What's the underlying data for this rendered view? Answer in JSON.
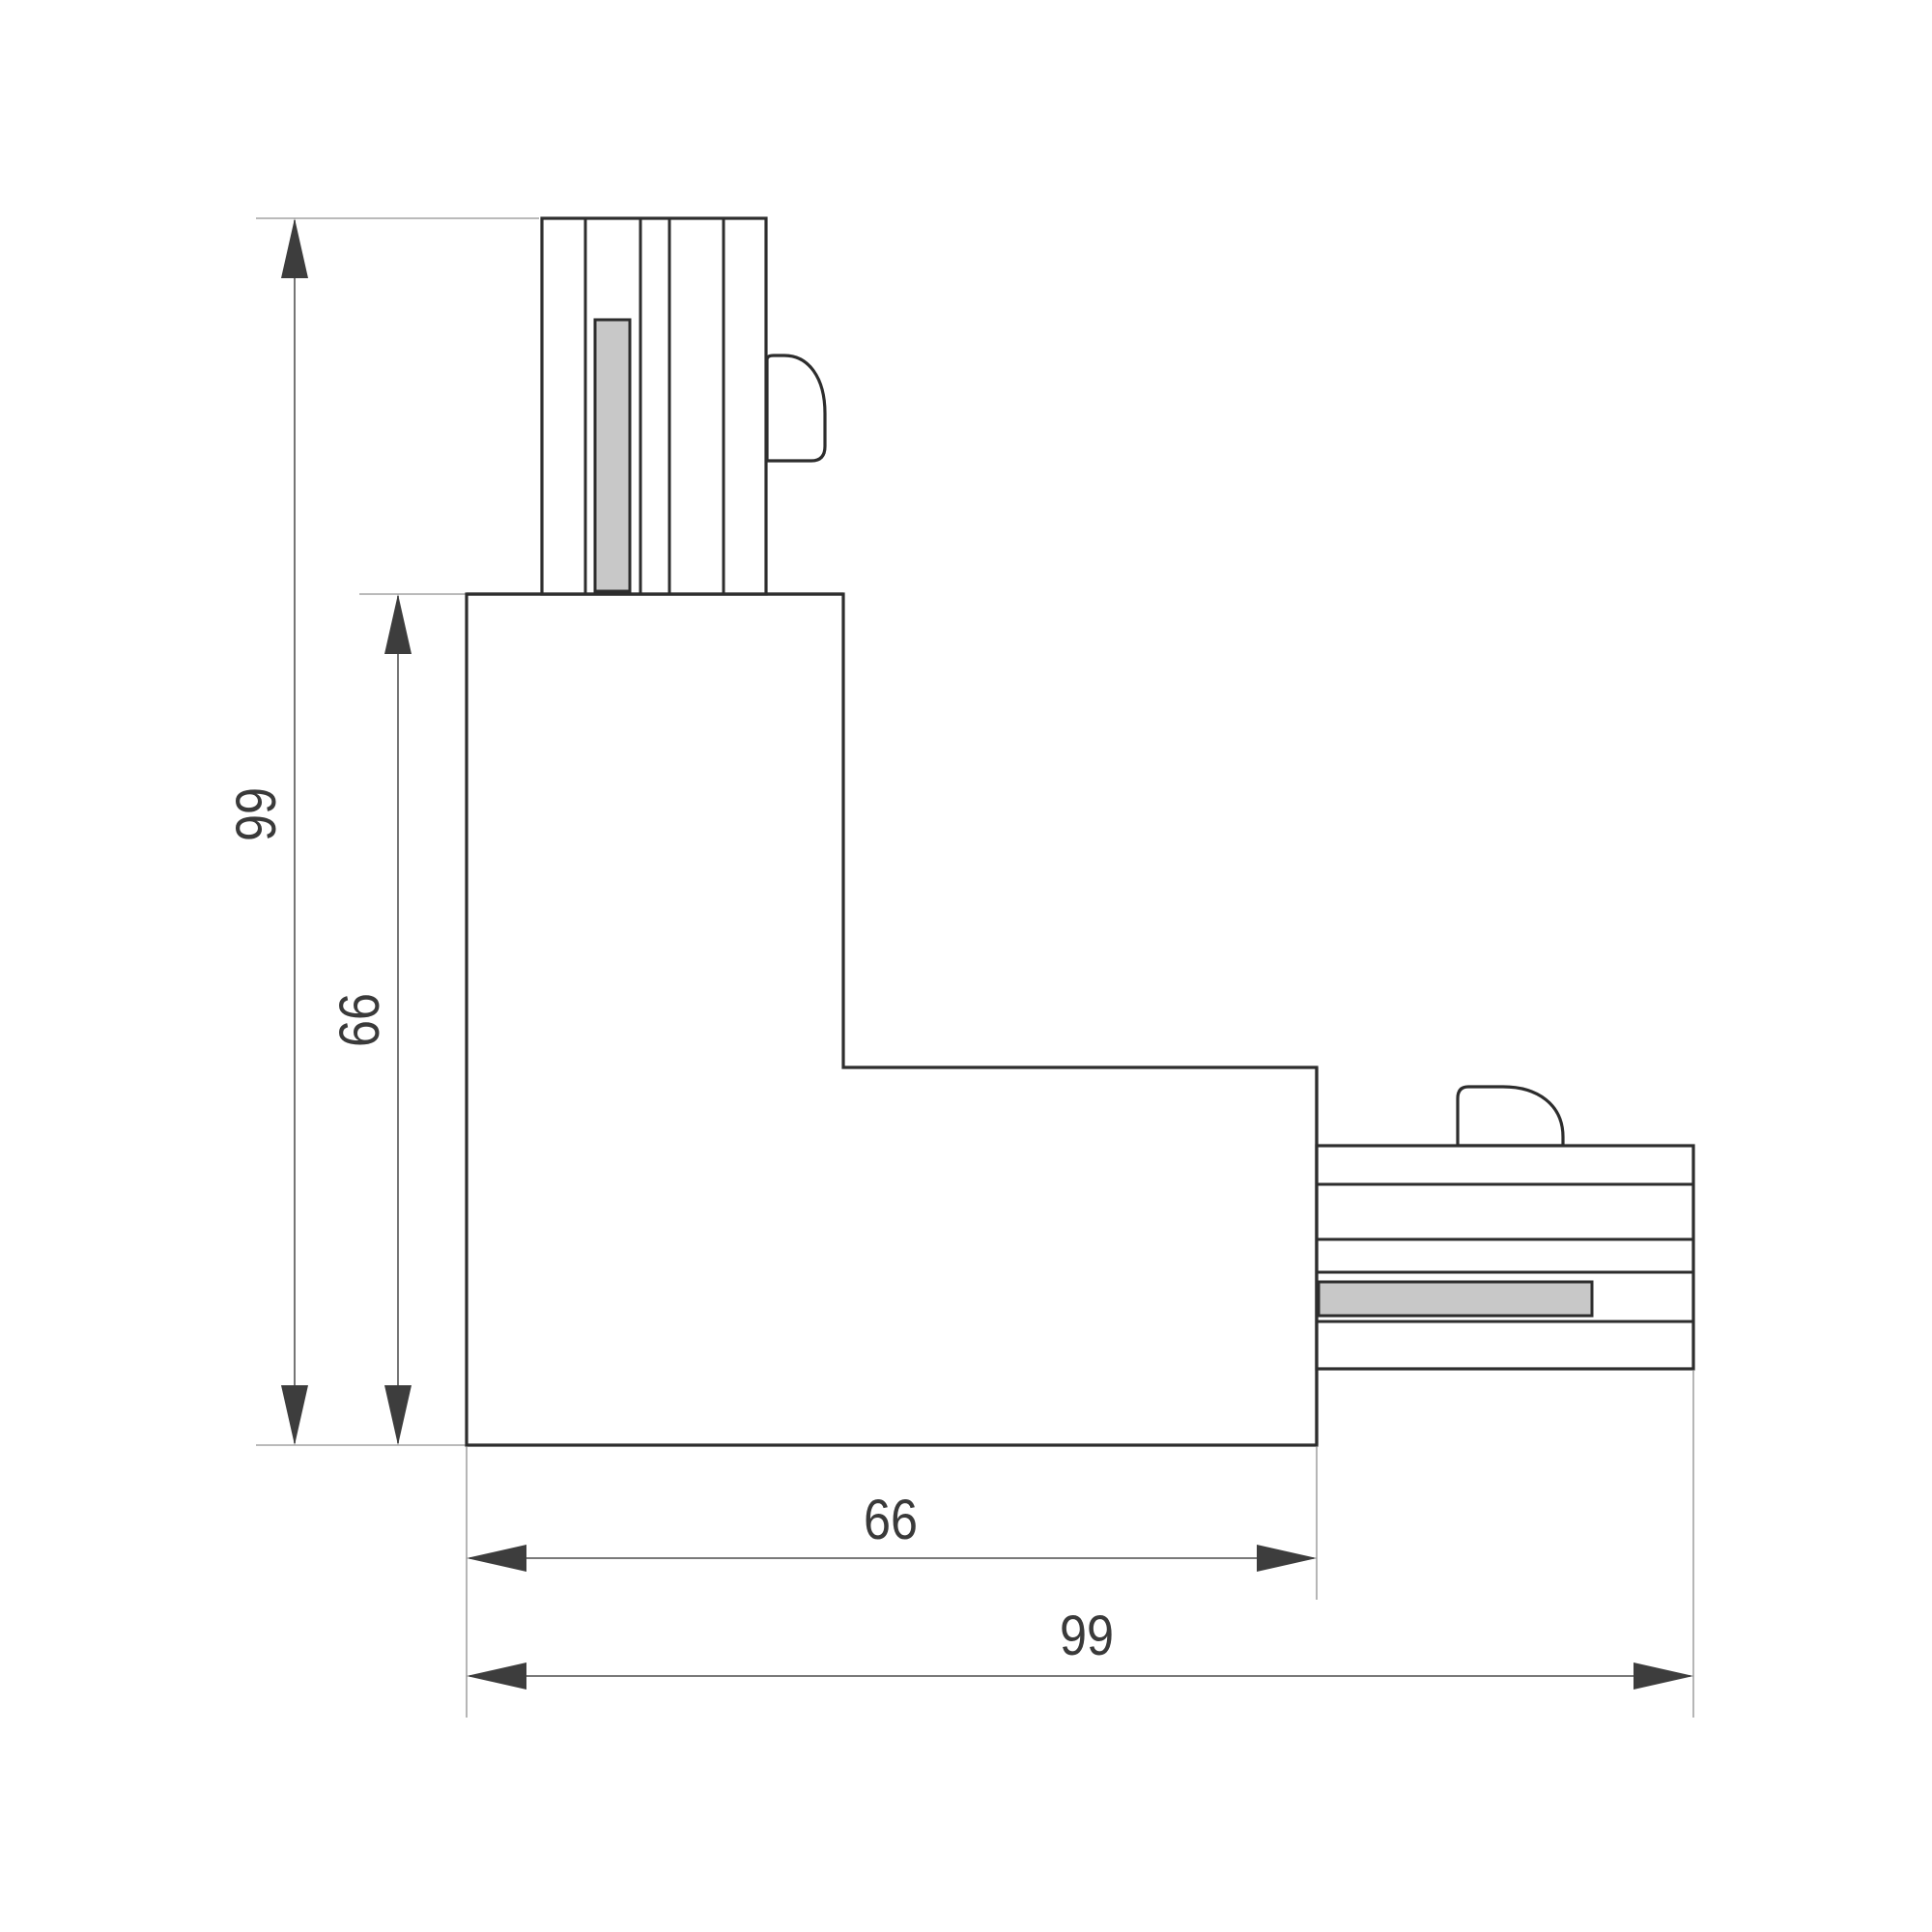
{
  "drawing": {
    "dimension_labels": {
      "vertical_outer": "99",
      "vertical_inner": "66",
      "horizontal_inner": "66",
      "horizontal_outer": "99"
    },
    "colors": {
      "background": "#ffffff",
      "outline": "#2d2d2d",
      "dim-line": "#666666",
      "ext-line": "#a3a3a3",
      "arrow": "#3d3d3d",
      "contact-fill": "#c8c8c8",
      "text": "#3a3a3a"
    }
  }
}
